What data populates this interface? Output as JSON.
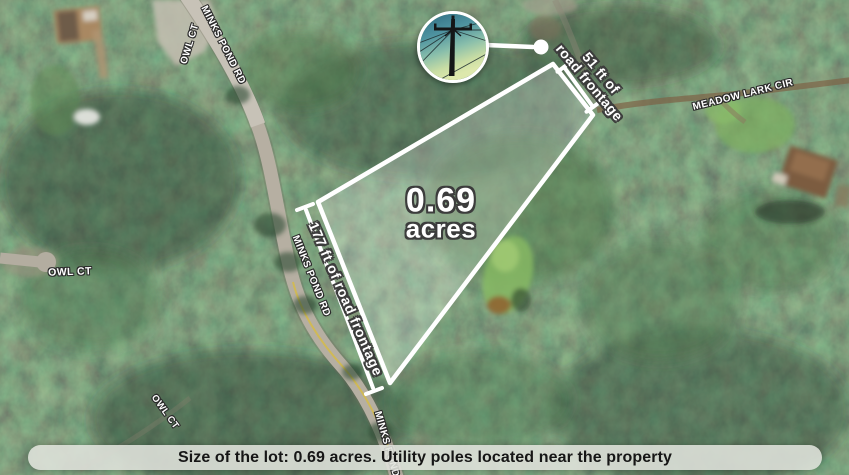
{
  "annotations": {
    "area": {
      "value": "0.69",
      "unit": "acres"
    },
    "frontage_left": "177 ft of road frontage",
    "frontage_right_line1": "51 ft of",
    "frontage_right_line2": "road frontage"
  },
  "road_labels": {
    "minks_pond_top": "MINKS POND RD",
    "minks_pond_mid": "MINKS POND RD",
    "minks_pond_bottom": "MINKS POND RD",
    "owl_ct_top": "OWL CT",
    "owl_ct_mid": "OWL CT",
    "owl_ct_bottom": "OWL CT",
    "meadow_lark_cir": "MEADOW LARK CIR"
  },
  "footer": {
    "text": "Size of the lot: 0.69 acres. Utility poles located near the property"
  },
  "inset": {
    "subject": "utility-pole-photo"
  },
  "colors": {
    "lot_outline": "#ffffff",
    "lot_fill_opacity": "0.24",
    "footer_bg": "#e0e2dc",
    "footer_text": "#161616",
    "road": "#b6afa2",
    "road_centerline": "#d3ba4e"
  }
}
